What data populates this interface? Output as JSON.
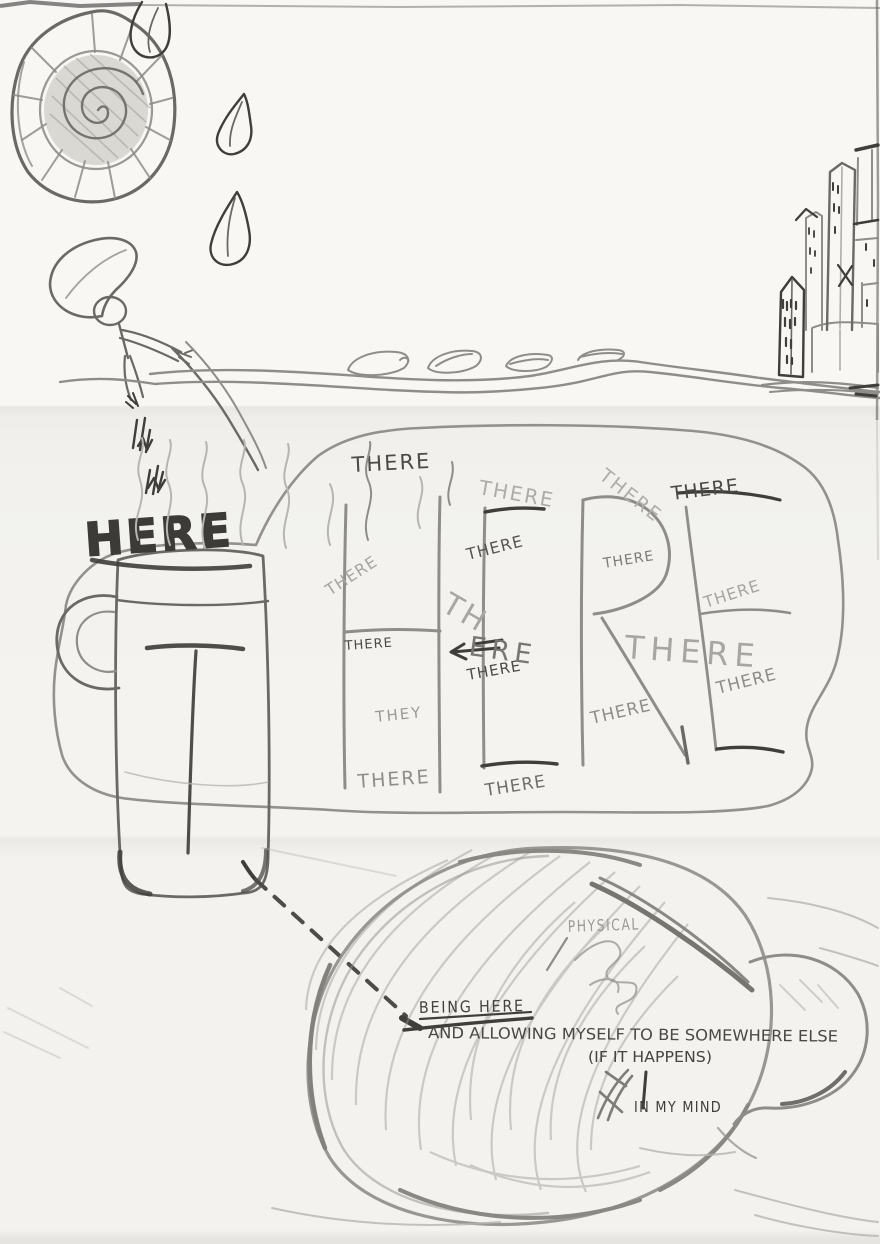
{
  "artwork": {
    "type": "hand-drawn pencil sketch",
    "labels": {
      "here": "HERE",
      "physical": "PHYSICAL",
      "being_here": "BEING HERE",
      "allowing": "AND ALLOWING MYSELF TO BE SOMEWHERE ELSE",
      "if_it_happens": "(IF IT HAPPENS)",
      "in_my_mind": "IN MY MIND"
    },
    "giant_word_on_mug_and_blob": "THERE",
    "scattered_words": [
      {
        "text": "THERE",
        "x": 352,
        "y": 472,
        "rot": -3,
        "size": 21,
        "color": "#4b4a48",
        "ls": 2
      },
      {
        "text": "THERE",
        "x": 478,
        "y": 494,
        "rot": 10,
        "size": 20,
        "color": "#aeaca8",
        "ls": 2
      },
      {
        "text": "THERE",
        "x": 598,
        "y": 478,
        "rot": 38,
        "size": 19,
        "color": "#b0aeaa",
        "ls": 2
      },
      {
        "text": "THERE",
        "x": 672,
        "y": 500,
        "rot": -7,
        "size": 19,
        "color": "#4b4a48",
        "ls": 1
      },
      {
        "text": "THERE",
        "x": 330,
        "y": 596,
        "rot": -33,
        "size": 16,
        "color": "#a6a4a1",
        "ls": 1
      },
      {
        "text": "THERE",
        "x": 468,
        "y": 560,
        "rot": -14,
        "size": 16,
        "color": "#565554",
        "ls": 1
      },
      {
        "text": "THERE",
        "x": 604,
        "y": 568,
        "rot": -9,
        "size": 14,
        "color": "#7b7a77",
        "ls": 1
      },
      {
        "text": "THERE",
        "x": 706,
        "y": 608,
        "rot": -18,
        "size": 16,
        "color": "#a6a4a1",
        "ls": 1
      },
      {
        "text": "THERE",
        "x": 345,
        "y": 650,
        "rot": -4,
        "size": 13,
        "color": "#4b4a48",
        "ls": 1
      },
      {
        "text": "THERE",
        "x": 468,
        "y": 680,
        "rot": -10,
        "size": 15,
        "color": "#4b4a48",
        "ls": 1
      },
      {
        "text": "THERE",
        "x": 718,
        "y": 694,
        "rot": -14,
        "size": 17,
        "color": "#8f8d8a",
        "ls": 1
      },
      {
        "text": "THEY",
        "x": 376,
        "y": 722,
        "rot": -6,
        "size": 15,
        "color": "#9b9996",
        "ls": 2
      },
      {
        "text": "THERE",
        "x": 592,
        "y": 724,
        "rot": -13,
        "size": 17,
        "color": "#8f8d8a",
        "ls": 1
      },
      {
        "text": "THERE",
        "x": 358,
        "y": 788,
        "rot": -4,
        "size": 19,
        "color": "#8f8d8a",
        "ls": 2
      },
      {
        "text": "THERE",
        "x": 486,
        "y": 796,
        "rot": -9,
        "size": 17,
        "color": "#6f6e6c",
        "ls": 1
      },
      {
        "text": "TH",
        "x": 440,
        "y": 610,
        "rot": 30,
        "size": 30,
        "color": "#a8a6a2",
        "ls": 3
      },
      {
        "text": "ERE",
        "x": 468,
        "y": 655,
        "rot": 8,
        "size": 27,
        "color": "#787672",
        "ls": 5
      },
      {
        "text": "THERE",
        "x": 624,
        "y": 658,
        "rot": 4,
        "size": 32,
        "color": "#a8a6a2",
        "ls": 6
      }
    ],
    "palette": {
      "paper": "#f4f3ef",
      "pencil_light": "#b7b5b0",
      "pencil": "#8f8d89",
      "pencil_dark": "#6b6965",
      "ink": "#3f3e3b"
    }
  }
}
